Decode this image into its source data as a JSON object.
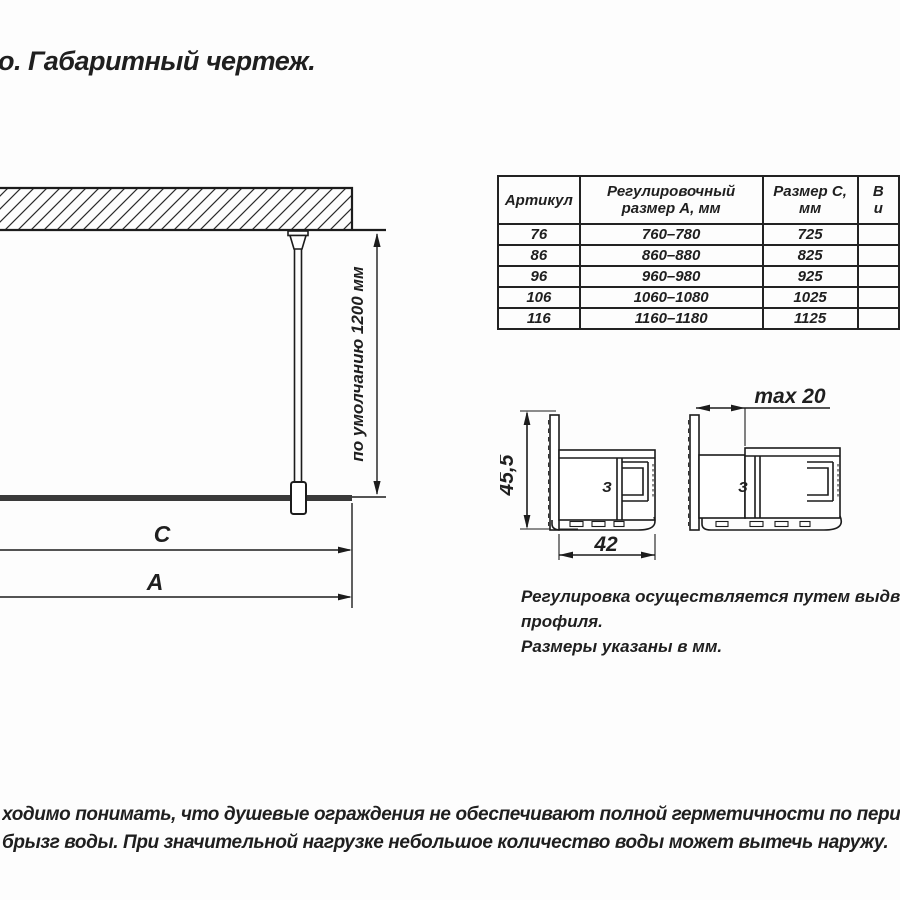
{
  "title": "о. Габаритный чертеж.",
  "table": {
    "headers": [
      "Артикул",
      "Регулировочный размер А, мм",
      "Размер С, мм"
    ],
    "header_partial": [
      "В",
      "и"
    ],
    "rows": [
      [
        "76",
        "760–780",
        "725"
      ],
      [
        "86",
        "860–880",
        "825"
      ],
      [
        "96",
        "960–980",
        "925"
      ],
      [
        "106",
        "1060–1080",
        "1025"
      ],
      [
        "116",
        "1160–1180",
        "1125"
      ]
    ]
  },
  "drawing": {
    "default_height_label": "по умолчанию 1200 мм",
    "dim_c_label": "C",
    "dim_a_label": "A"
  },
  "profiles": {
    "height_label": "45,5",
    "width_label": "42",
    "max_slide_label": "max 20",
    "clip_glyph": "З"
  },
  "notes": {
    "line1": "Регулировка осуществляется путем выдвижени",
    "line2": "профиля.",
    "line3": "Размеры указаны в мм."
  },
  "footer": {
    "line1": "ходимо понимать, что душевые ограждения не обеспечивают полной герметичности по периметру, а предназначе",
    "line2": "брызг воды. При значительной нагрузке небольшое количество воды может вытечь наружу."
  },
  "colors": {
    "line": "#1c1c1c",
    "glass": "#3a3a3a",
    "text": "#1f1f1f"
  }
}
